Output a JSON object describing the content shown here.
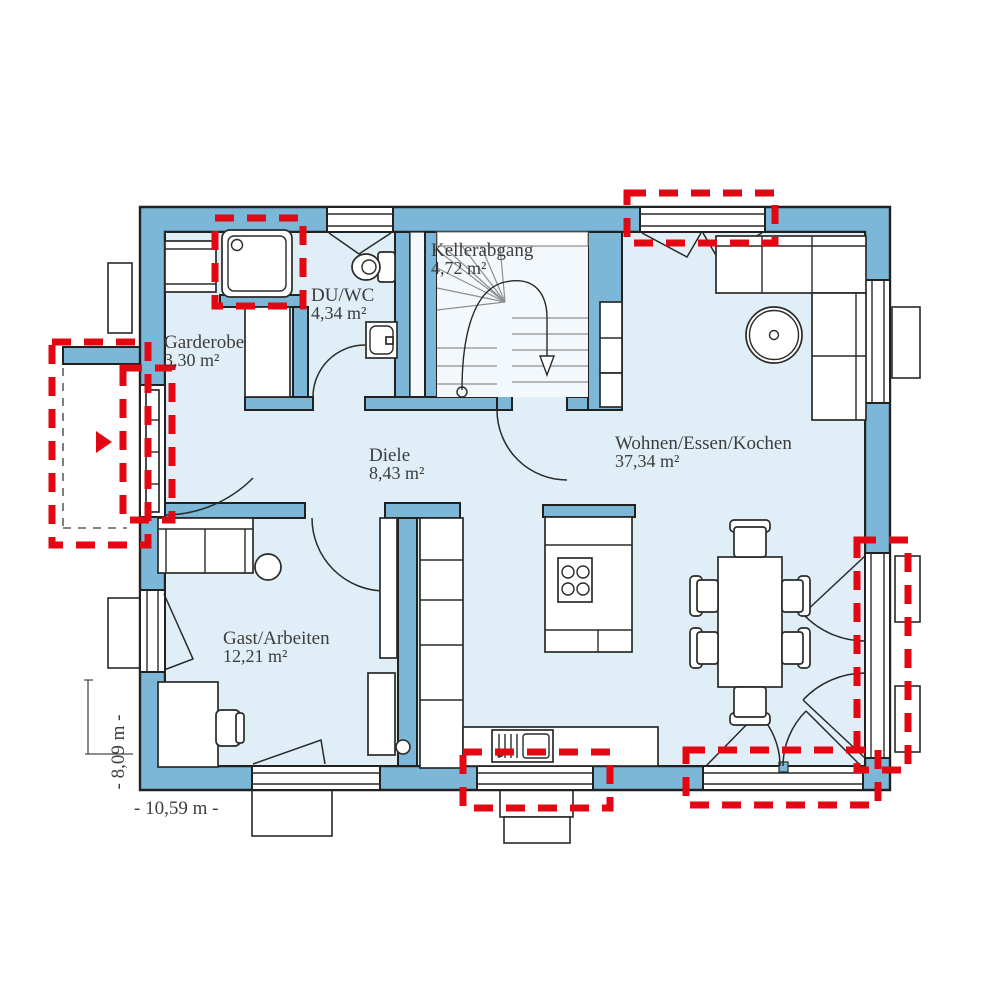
{
  "plan": {
    "rooms": [
      {
        "name": "Kellerabgang",
        "area": "4,72 m²"
      },
      {
        "name": "DU/WC",
        "area": "4,34 m²"
      },
      {
        "name": "Garderobe",
        "area": "3,30 m²"
      },
      {
        "name": "Diele",
        "area": "8,43 m²"
      },
      {
        "name": "Wohnen/Essen/Kochen",
        "area": "37,34 m²"
      },
      {
        "name": "Gast/Arbeiten",
        "area": "12,21 m²"
      }
    ],
    "dimensions": {
      "width_label": "- 10,59 m -",
      "height_label": "- 8,09 m -"
    },
    "colors": {
      "wall_blue": "#7cb7d8",
      "floor_blue": "#dfeef7",
      "outline_dark": "#21211f",
      "highlight_red": "#e30613",
      "stair_tread_gray": "#8f8f8f",
      "text_gray": "#3d3d3b"
    },
    "highlighted_elements": [
      "shower",
      "entrance-door",
      "entrance-porch",
      "living-top-window",
      "terrace-door-right",
      "kitchen-window",
      "dining-terrace-door"
    ]
  }
}
